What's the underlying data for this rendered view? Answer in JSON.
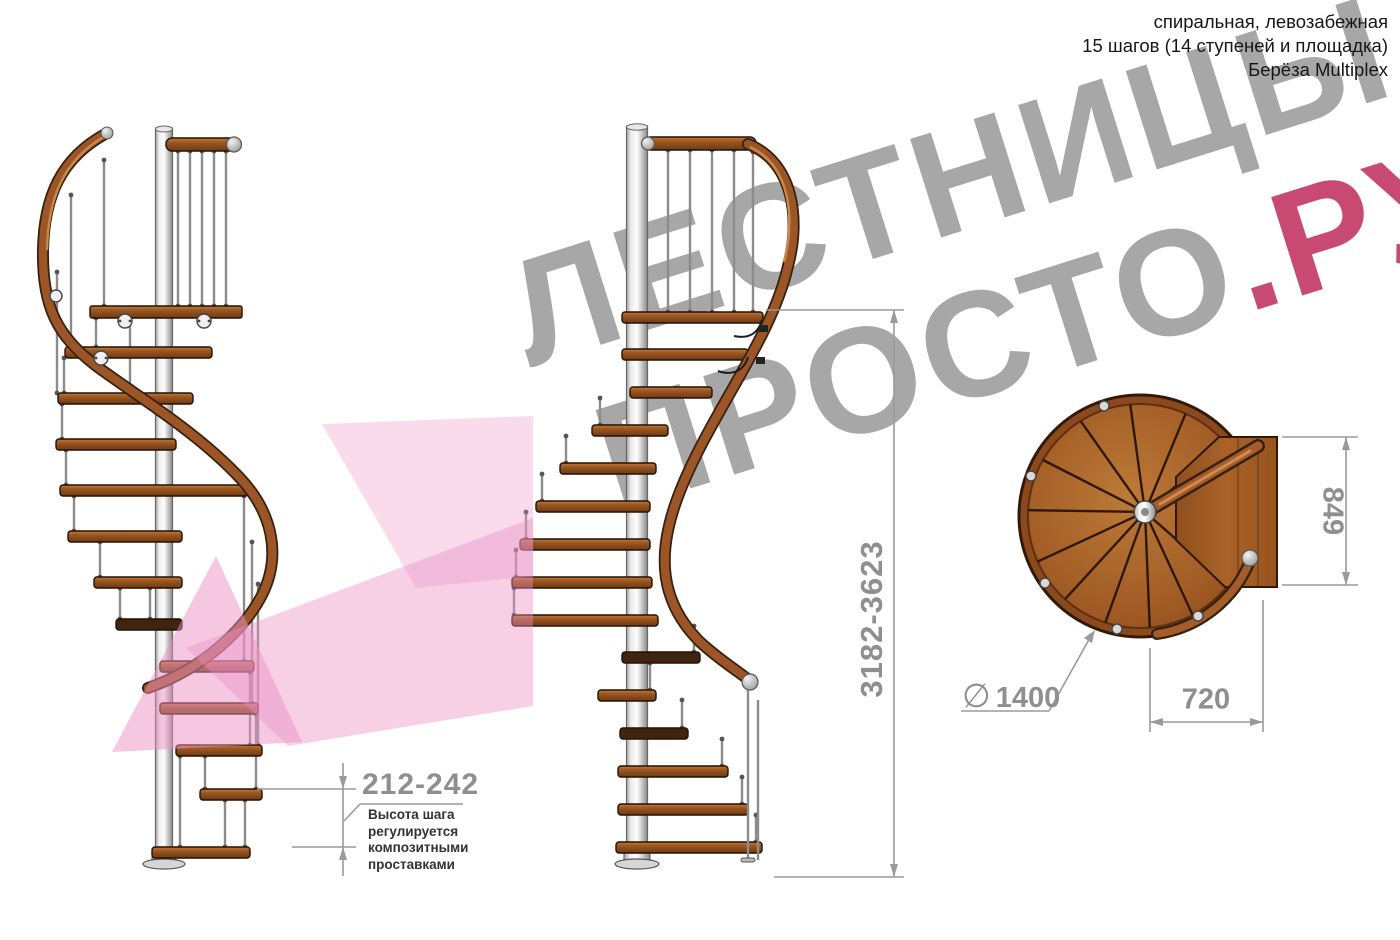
{
  "header": {
    "type_line": "спиральная, левозабежная",
    "steps_line": "15 шагов (14 ступеней и площадка)",
    "material_line": "Берёза Multiplex"
  },
  "watermark": {
    "line1": "ЛЕСТНИЦЫ",
    "line2_main": "ПРОСТО",
    "line2_accent": ".РУ"
  },
  "dimensions": {
    "total_height": "3182-3623",
    "step_height": "212-242",
    "step_height_note": "Высота шага\nрегулируется\nкомпозитными\nпроставками",
    "platform_depth": "849",
    "landing_width": "720",
    "diameter_symbol": "∅",
    "diameter": "1400"
  },
  "colors": {
    "watermark_gray": "#a7a7a7",
    "watermark_accent": "#c84a72",
    "arrow_pink": "#ec8fc4",
    "dimension_gray": "#8f8f8f",
    "note_text": "#333333",
    "header_text": "#161616",
    "wood": "#9c5722",
    "steel": "#c9c9c9"
  }
}
